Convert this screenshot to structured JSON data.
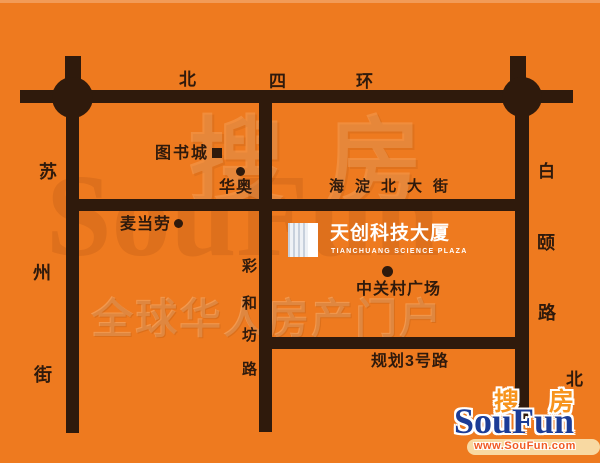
{
  "canvas": {
    "bg_color": "#ee7a1f",
    "road_color": "#2f1a0c",
    "label_color": "#2f1a0c"
  },
  "roads": {
    "north_fourth_ring": {
      "name": "北四环",
      "chars": [
        "北",
        "四",
        "环"
      ]
    },
    "suzhou_street": {
      "name": "苏州街",
      "chars": [
        "苏",
        "州",
        "街"
      ]
    },
    "baiyi_road": {
      "name": "白颐路",
      "chars": [
        "白",
        "颐",
        "路"
      ],
      "direction_char": "北"
    },
    "haidian_north_street": {
      "label": "海淀北大街"
    },
    "caihefang_road": {
      "name": "彩和坊路",
      "chars": [
        "彩",
        "和",
        "坊",
        "路"
      ]
    },
    "planned_road_3": {
      "label": "规划3号路"
    }
  },
  "pois": {
    "book_city": {
      "label": "图书城",
      "marker": "square"
    },
    "huaao": {
      "label": "华奥",
      "marker": "dot"
    },
    "mcdonalds": {
      "label": "麦当劳",
      "marker": "dot"
    },
    "zhongguancun_plaza": {
      "label": "中关村广场",
      "marker": "dot"
    }
  },
  "building": {
    "name": "天创科技大厦",
    "subtitle": "TIANCHUANG SCIENCE PLAZA"
  },
  "watermark": {
    "zh": "搜房",
    "en": "SouFun",
    "slogan": "全球华人房产门户"
  },
  "logo": {
    "zh_left": "搜",
    "zh_right": "房",
    "en": "SouFun",
    "url": "www.SouFun.com",
    "colors": {
      "blue": "#1c3c96",
      "orange": "#f7941d",
      "url_text": "#f15a22",
      "strip": "#f8d9a2"
    }
  }
}
